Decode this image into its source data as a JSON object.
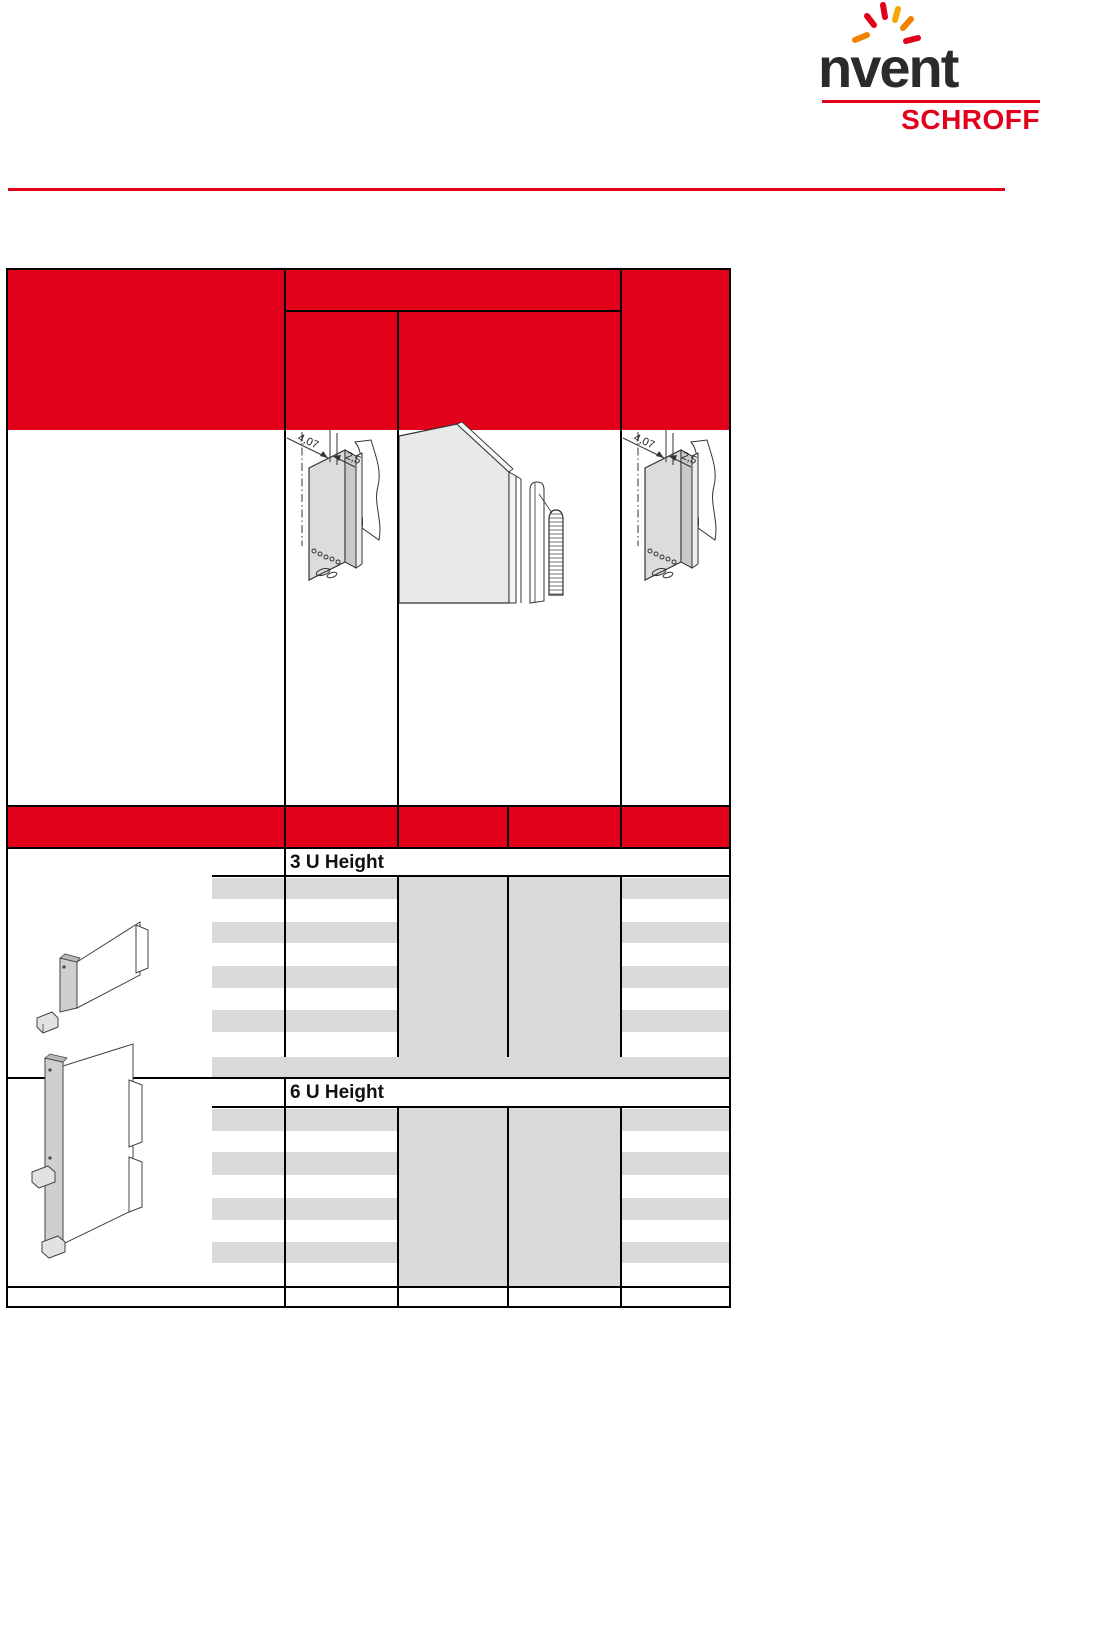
{
  "logo": {
    "brand": "nvent",
    "sub_brand": "SCHROFF",
    "underline_color": "#e2001a",
    "spark_colors": [
      "#e2001a",
      "#f08300",
      "#f5a800"
    ]
  },
  "page": {
    "rule_color": "#e2001a",
    "background": "#ffffff"
  },
  "table": {
    "header_fill": "#e2001a",
    "stripe_fill": "#d9d9d9",
    "border_color": "#000000",
    "sections": [
      {
        "label": "3 U Height",
        "empty_rows": 4
      },
      {
        "label": "6 U Height",
        "empty_rows": 4
      }
    ]
  },
  "drawings": {
    "dim_depth": "4,07",
    "dim_offset": "2,5"
  }
}
